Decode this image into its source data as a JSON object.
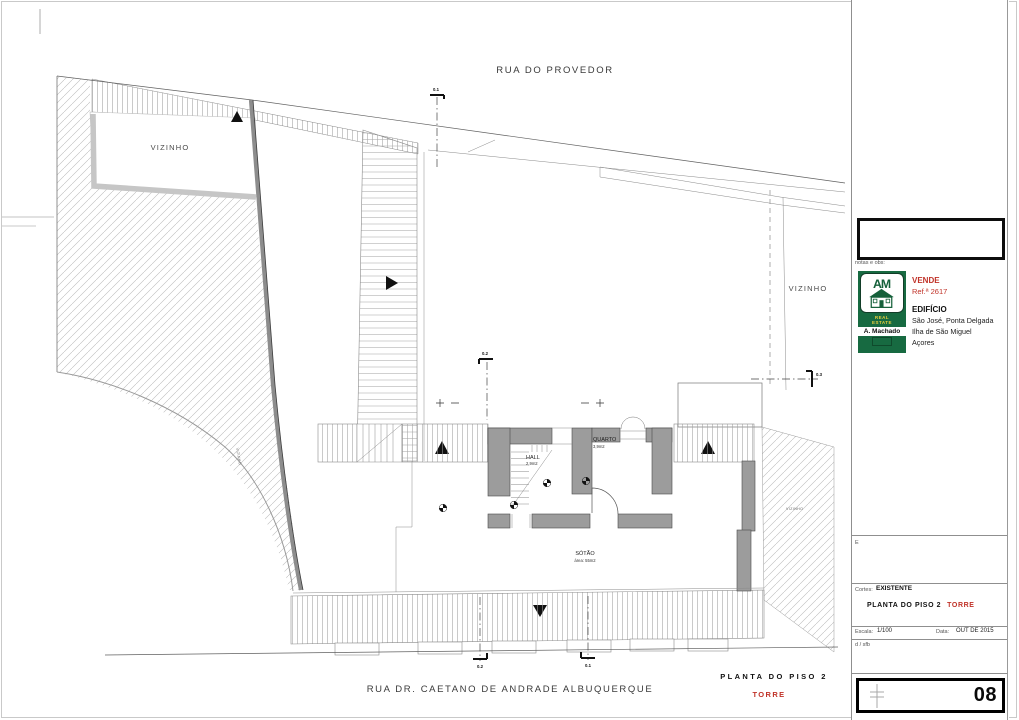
{
  "colors": {
    "accent_red": "#c03228",
    "logo_green": "#176a41"
  },
  "drawing": {
    "street_top": "RUA DO PROVEDOR",
    "street_bottom": "RUA DR. CAETANO DE ANDRADE ALBUQUERQUE",
    "vizinho_left": "VIZINHO",
    "vizinho_right": "VIZINHO",
    "vizinho_small_left": "VIZINHO",
    "vizinho_small_right": "VIZINHO",
    "room_quarto": {
      "name": "QUARTO",
      "area": "3,9m2"
    },
    "room_hall": {
      "name": "HALL",
      "area": "2,9m2"
    },
    "room_sotao": {
      "name": "SÓTÃO",
      "area": "área: 55m2"
    },
    "sections": {
      "top": "0.1",
      "mid": "0.2",
      "right": "0.3",
      "bottom_left": "0.2",
      "bottom_right": "0.1"
    },
    "caption": {
      "title": "PLANTA DO PISO 2",
      "subtitle": "TORRE"
    }
  },
  "titleblock": {
    "notes_label": "notas e obs:",
    "logo": {
      "monogram": "AM",
      "realestate_line1": "REAL",
      "realestate_line2": "ESTATE",
      "name": "A. Machado"
    },
    "listing": {
      "action": "VENDE",
      "ref": "Ref.ª 2617"
    },
    "property": {
      "type": "EDIFÍCIO",
      "address1": "São José, Ponta Delgada",
      "address2": "Ilha de São Miguel",
      "address3": "Açores"
    },
    "note_field": "E",
    "status": {
      "label": "Cortes:",
      "value": "EXISTENTE"
    },
    "drawing_title": {
      "label": "PLANTA DO PISO 2",
      "tower": "TORRE"
    },
    "scale": {
      "label": "Escala:",
      "value": "1/100"
    },
    "date": {
      "label": "Data:",
      "value": "OUT DE 2015"
    },
    "initials": "d / sfb",
    "sheet_number": "08"
  }
}
